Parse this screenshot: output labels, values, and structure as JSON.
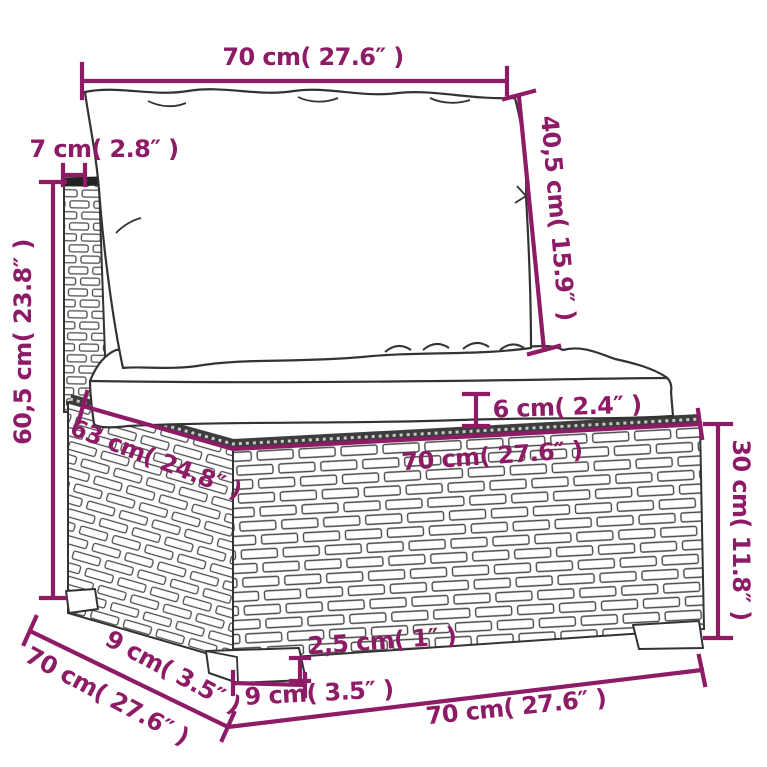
{
  "diagram": {
    "subject": "poly-rattan sectional middle sofa with cushions, dimension drawing",
    "colors": {
      "dimension": "#8e1b66",
      "sketch": "#333333",
      "cushion_fill": "#ffffff",
      "background": "#ffffff"
    },
    "labels": {
      "top_width": "70 cm( 27.6″  )",
      "back_depth": "7 cm( 2.8″  )",
      "back_cushion_height": "40,5 cm( 15.9″  )",
      "total_height": "60,5 cm( 23.8″  )",
      "cushion_thickness": "6 cm( 2.4″  )",
      "seat_depth": "63 cm( 24.8″  )",
      "seat_width": "70 cm( 27.6″  )",
      "base_height": "30 cm( 11.8″  )",
      "foot_inset_depth": "9 cm( 3.5″  )",
      "total_depth": "70 cm( 27.6″  )",
      "foot_height": "2,5 cm( 1″  )",
      "foot_width": "9 cm( 3.5″  )",
      "bottom_width": "70 cm( 27.6″  )"
    }
  }
}
